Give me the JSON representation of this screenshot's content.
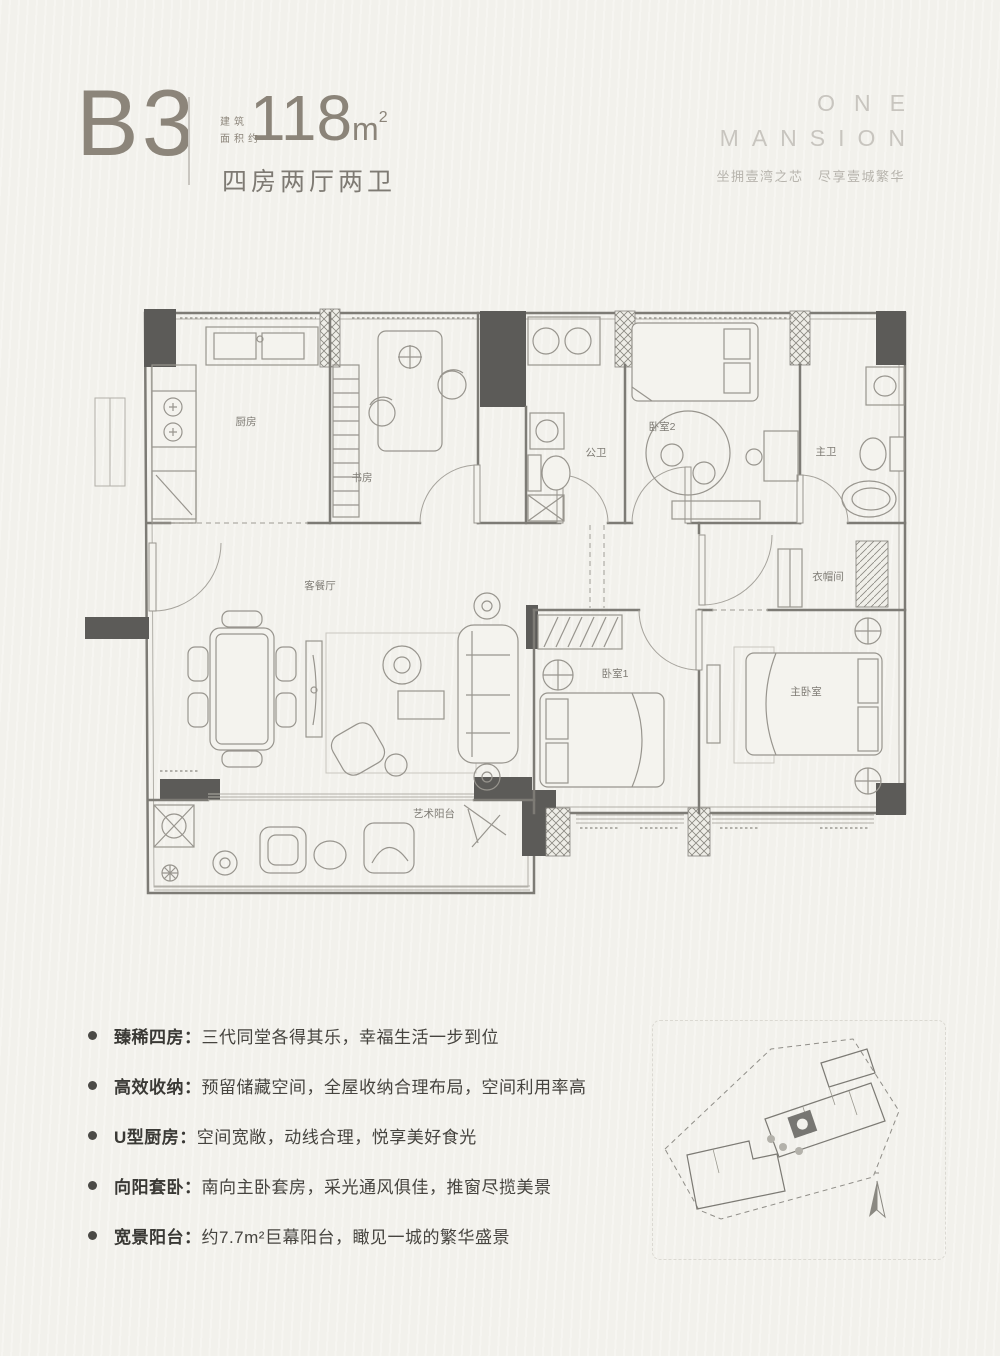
{
  "header": {
    "unit_code": "B3",
    "area_label_line1": "建筑",
    "area_label_line2": "面积约",
    "area_value": "118",
    "area_unit_base": "m",
    "area_unit_sup": "2",
    "layout_text": "四房两厅两卫"
  },
  "brand": {
    "name_line1": "ONE",
    "name_line2": "MANSION",
    "tagline": "坐拥壹湾之芯　尽享壹城繁华"
  },
  "floorplan": {
    "rooms": {
      "kitchen": "厨房",
      "study": "书房",
      "public_bath": "公卫",
      "bedroom2": "卧室2",
      "master_bath": "主卫",
      "living_dining": "客餐厅",
      "bedroom1": "卧室1",
      "master_bedroom": "主卧室",
      "cloakroom": "衣帽间",
      "art_balcony": "艺术阳台"
    }
  },
  "features": [
    {
      "title": "臻稀四房：",
      "desc": "三代同堂各得其乐，幸福生活一步到位"
    },
    {
      "title": "高效收纳：",
      "desc": "预留储藏空间，全屋收纳合理布局，空间利用率高"
    },
    {
      "title": "U型厨房：",
      "desc": "空间宽敞，动线合理，悦享美好食光"
    },
    {
      "title": "向阳套卧：",
      "desc": "南向主卧套房，采光通风俱佳，推窗尽揽美景"
    },
    {
      "title": "宽景阳台：",
      "desc": "约7.7m²巨幕阳台，瞰见一城的繁华盛景"
    }
  ],
  "colors": {
    "background": "#f2f1ec",
    "heading": "#8b8479",
    "text_dark": "#3a3935",
    "brand_gray": "#c8c5bf",
    "wall_dark": "#5c5b58",
    "line_gray": "#98958e"
  }
}
